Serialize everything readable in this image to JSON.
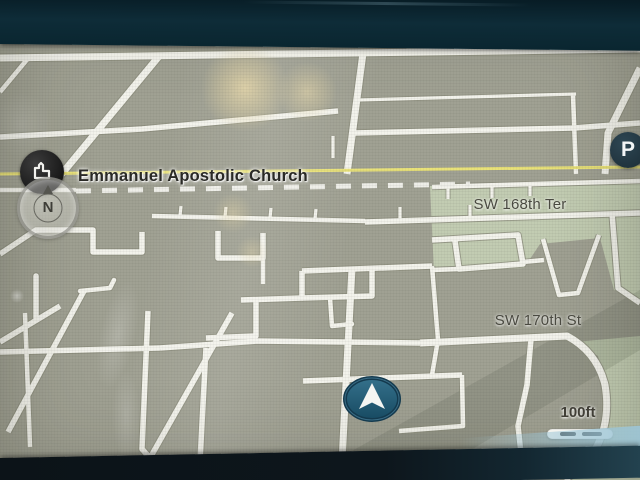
{
  "device": {
    "screen_label": "vehicle navigation map display"
  },
  "poi": {
    "label": "Emmanuel Apostolic Church",
    "icon": "church-building-icon"
  },
  "compass": {
    "label": "N",
    "mode": "north-up"
  },
  "parking": {
    "label": "P"
  },
  "streets": [
    {
      "name": "SW 168th Ter"
    },
    {
      "name": "SW 170th St"
    }
  ],
  "scale": {
    "label": "100ft"
  },
  "colors": {
    "map_background": "#a0a193",
    "map_green_zone": "#c4cfb4",
    "road_fill": "#f3f3ec",
    "road_casing": "#8d8f7e",
    "route_highlight_yellow": "#e9e279",
    "bezel_top": "#0e2c38",
    "bezel_bottom": "#0c1318",
    "poi_circle": "#181818",
    "parking_badge": "#20333d",
    "vehicle_marker_fill": "#2d6882",
    "vehicle_marker_ring": "#143a4e",
    "label_text": "#2a2a26",
    "street_text": "#4a4a41"
  }
}
